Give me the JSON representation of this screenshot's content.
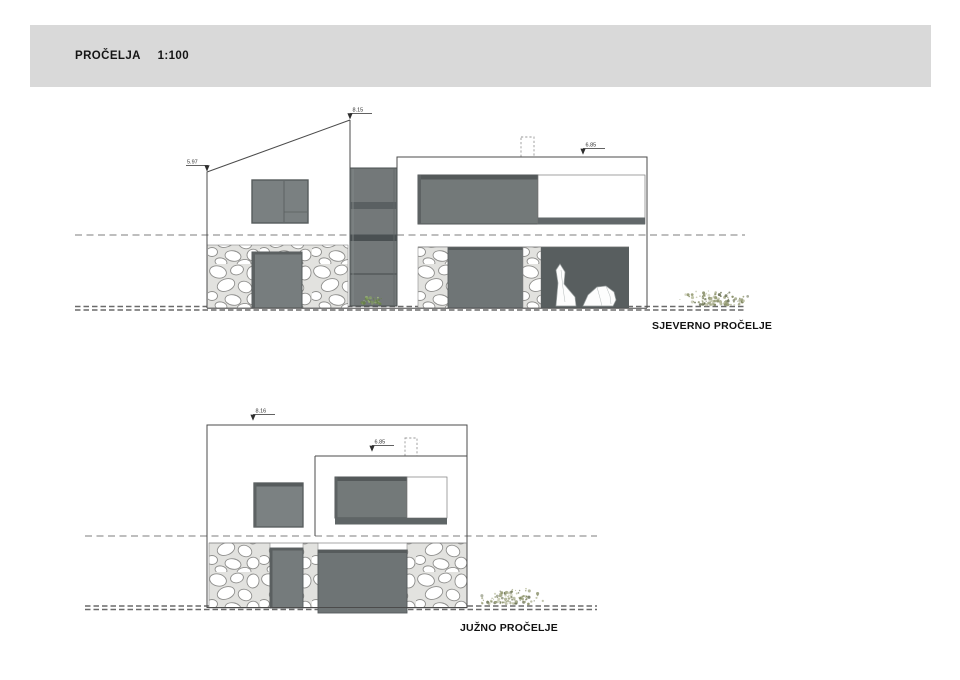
{
  "header": {
    "title": "PROČELJA  1:100"
  },
  "drawings": {
    "north": {
      "label": "SJEVERNO PROČELJE",
      "spot_heights": {
        "ridge": "8.15",
        "eave": "5.97",
        "parapet": "6.85"
      }
    },
    "south": {
      "label": "JUŽNO PROČELJE",
      "spot_heights": {
        "ridge": "8.16",
        "parapet": "6.85"
      }
    }
  },
  "scale": "1:100",
  "colors": {
    "header_band": "#d9d9d9",
    "line": "#4b4b4b",
    "glass_light": "#7a8081",
    "glass_mid": "#737879",
    "glass_dark": "#565c5d",
    "stone_mortar": "#e2e2df",
    "dashed_line": "#7d7d7d",
    "plant_dry": "#9aa078",
    "plant_green": "#7f9a5e"
  }
}
